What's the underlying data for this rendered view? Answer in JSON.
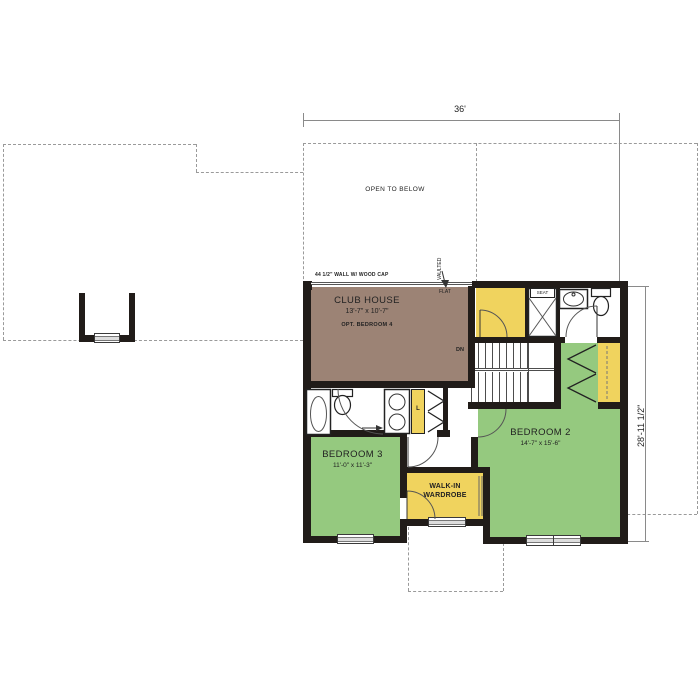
{
  "dimensions": {
    "top_width": "36'",
    "right_height": "28'-11 1/2\""
  },
  "annotations": {
    "open_to_below": "OPEN TO BELOW",
    "wall_note": "44 1/2\" WALL W/ WOOD CAP",
    "vaulted": "VAULTED",
    "flat": "FLAT",
    "down": "DN",
    "seat": "SEAT",
    "linen": "L"
  },
  "rooms": {
    "club_house": {
      "name": "CLUB HOUSE",
      "dims": "13'-7\" x 10'-7\"",
      "note": "OPT. BEDROOM 4"
    },
    "bedroom2": {
      "name": "BEDROOM 2",
      "dims": "14'-7\" x 15'-6\""
    },
    "bedroom3": {
      "name": "BEDROOM 3",
      "dims": "11'-0\" x 11'-3\""
    },
    "wardrobe": {
      "name_line1": "WALK-IN",
      "name_line2": "WARDROBE"
    }
  },
  "colors": {
    "wall": "#211c19",
    "club_house_fill": "#9c8375",
    "bedroom_fill": "#95c97f",
    "closet_fill": "#f0d35e",
    "roof_dash": "#9a9a9a",
    "dimension_line": "#8a8a8a"
  }
}
